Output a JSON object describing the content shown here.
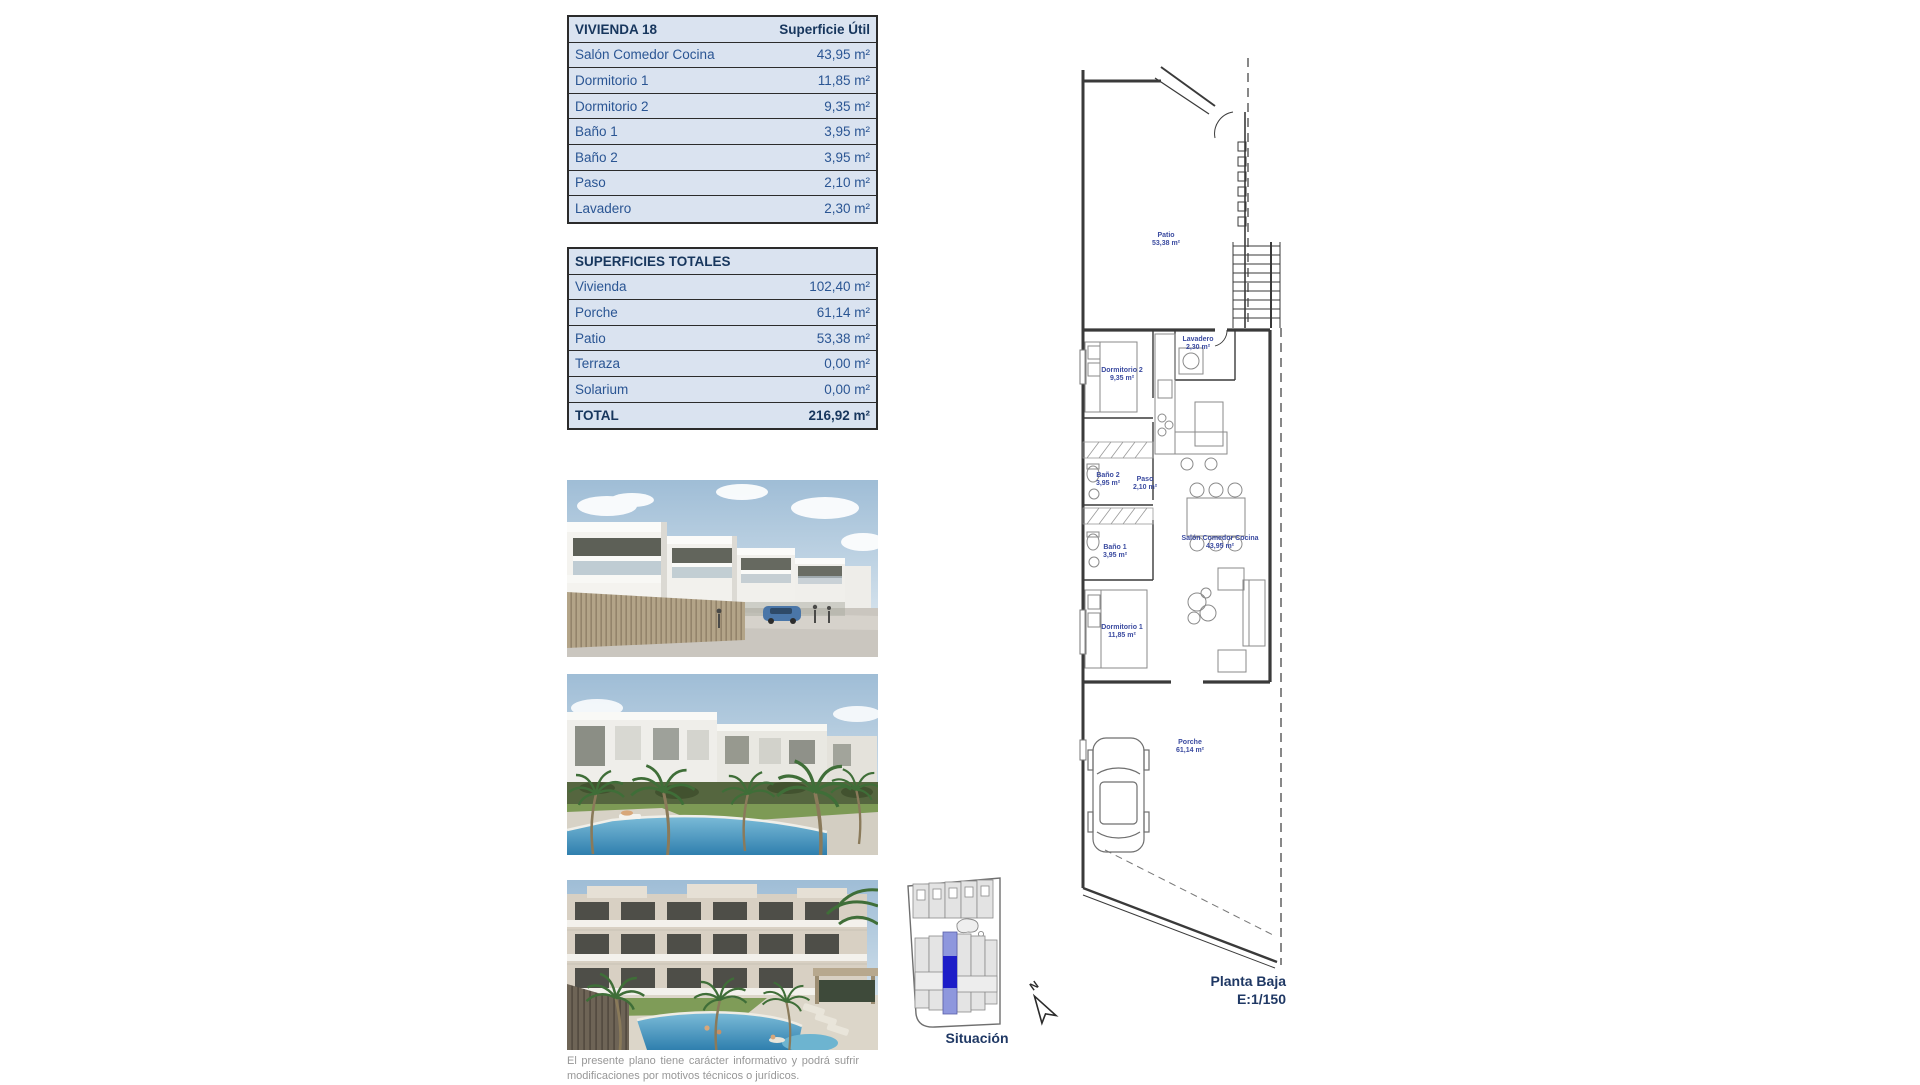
{
  "tables": {
    "vivienda": {
      "title": "VIVIENDA 18",
      "header_value": "Superficie Útil",
      "rows": [
        {
          "label": "Salón Comedor Cocina",
          "value": "43,95 m²"
        },
        {
          "label": "Dormitorio 1",
          "value": "11,85 m²"
        },
        {
          "label": "Dormitorio 2",
          "value": "9,35 m²"
        },
        {
          "label": "Baño 1",
          "value": "3,95 m²"
        },
        {
          "label": "Baño 2",
          "value": "3,95 m²"
        },
        {
          "label": "Paso",
          "value": "2,10 m²"
        },
        {
          "label": "Lavadero",
          "value": "2,30 m²"
        }
      ]
    },
    "totales": {
      "title": "SUPERFICIES TOTALES",
      "rows": [
        {
          "label": "Vivienda",
          "value": "102,40 m²"
        },
        {
          "label": "Porche",
          "value": "61,14 m²"
        },
        {
          "label": "Patio",
          "value": "53,38 m²"
        },
        {
          "label": "Terraza",
          "value": "0,00 m²"
        },
        {
          "label": "Solarium",
          "value": "0,00 m²"
        }
      ],
      "total": {
        "label": "TOTAL",
        "value": "216,92 m²"
      }
    }
  },
  "plan": {
    "title": "Planta Baja",
    "scale": "E:1/150",
    "rooms": [
      {
        "name": "Patio",
        "area": "53,38 m²"
      },
      {
        "name": "Lavadero",
        "area": "2,30 m²"
      },
      {
        "name": "Dormitorio 2",
        "area": "9,35 m²"
      },
      {
        "name": "Baño 2",
        "area": "3,95 m²"
      },
      {
        "name": "Paso",
        "area": "2,10 m²"
      },
      {
        "name": "Baño 1",
        "area": "3,95 m²"
      },
      {
        "name": "Salón Comedor Cocina",
        "area": "43,95 m²"
      },
      {
        "name": "Dormitorio 1",
        "area": "11,85 m²"
      },
      {
        "name": "Porche",
        "area": "61,14 m²"
      }
    ]
  },
  "situacion": {
    "label": "Situación",
    "north_label": "N",
    "highlight_color": "#1d1dc8",
    "strip_color": "#8e97dd"
  },
  "disclaimer": {
    "line1": "El presente plano tiene carácter informativo y podrá sufrir",
    "line2": "modificaciones por motivos técnicos o jurídicos."
  },
  "colors": {
    "table_fill": "#dae3f0",
    "table_border": "#2b2b2b",
    "heading_text": "#17365d",
    "row_text": "#2a5593",
    "plan_label_text": "#3b4ba0"
  }
}
